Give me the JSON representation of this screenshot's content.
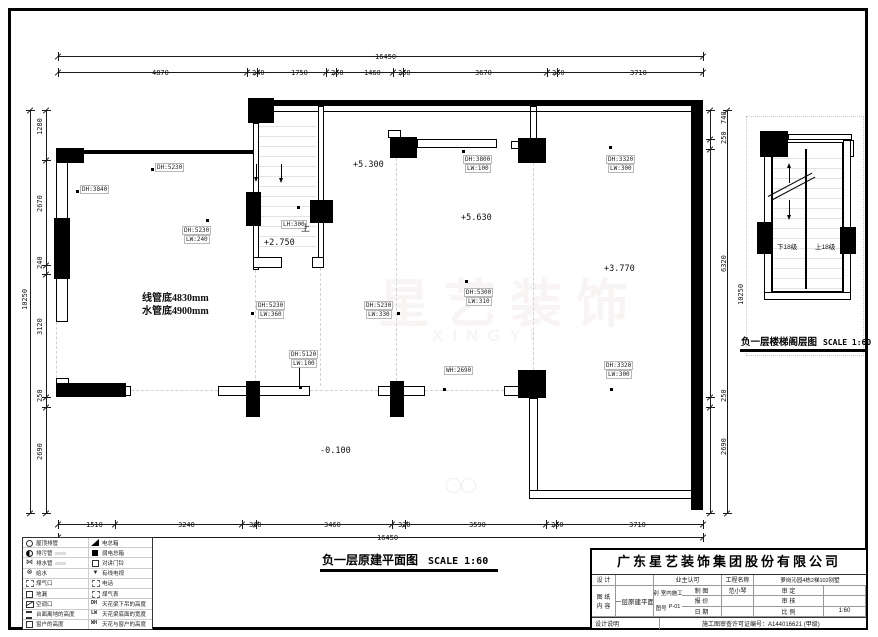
{
  "titles": {
    "main": "负一层原建平面图",
    "main_scale": "SCALE 1:60",
    "detail": "负一层楼梯阁层图",
    "detail_scale": "SCALE 1:60"
  },
  "watermark": {
    "cn": "星艺装饰",
    "en": "XINGYI"
  },
  "colors": {
    "wall": "#000000",
    "guide": "#d2d2d2",
    "watermark": "rgba(185,145,145,0.10)"
  },
  "plan": {
    "solid": [
      [
        248,
        98,
        26,
        25
      ],
      [
        253,
        100,
        450,
        6
      ],
      [
        56,
        148,
        28,
        15
      ],
      [
        56,
        150,
        197,
        4
      ],
      [
        54,
        218,
        16,
        61
      ],
      [
        56,
        383,
        70,
        14
      ],
      [
        246,
        192,
        15,
        34
      ],
      [
        310,
        200,
        23,
        23
      ],
      [
        390,
        137,
        27,
        21
      ],
      [
        518,
        138,
        28,
        25
      ],
      [
        691,
        100,
        12,
        410
      ],
      [
        246,
        381,
        14,
        36
      ],
      [
        390,
        381,
        14,
        36
      ],
      [
        518,
        370,
        28,
        28
      ],
      [
        760,
        131,
        28,
        26
      ],
      [
        757,
        222,
        15,
        32
      ],
      [
        840,
        227,
        16,
        27
      ]
    ],
    "hollow": [
      [
        56,
        150,
        12,
        172
      ],
      [
        253,
        123,
        6,
        147
      ],
      [
        253,
        257,
        29,
        11
      ],
      [
        318,
        106,
        6,
        152
      ],
      [
        312,
        257,
        12,
        11
      ],
      [
        388,
        130,
        13,
        8
      ],
      [
        417,
        139,
        80,
        9
      ],
      [
        530,
        106,
        7,
        33
      ],
      [
        511,
        141,
        8,
        8
      ],
      [
        218,
        386,
        92,
        10
      ],
      [
        378,
        386,
        47,
        10
      ],
      [
        56,
        378,
        13,
        6
      ],
      [
        122,
        386,
        9,
        10
      ],
      [
        504,
        386,
        15,
        10
      ],
      [
        529,
        398,
        9,
        96
      ],
      [
        529,
        490,
        168,
        9
      ],
      [
        788,
        134,
        64,
        6
      ],
      [
        848,
        140,
        6,
        17
      ],
      [
        764,
        140,
        8,
        158
      ],
      [
        843,
        140,
        8,
        158
      ],
      [
        764,
        292,
        87,
        8
      ]
    ],
    "outline": [
      [
        772,
        142,
        71,
        150
      ]
    ],
    "lines": [
      [
        259,
        111,
        59,
        1
      ],
      [
        323,
        111,
        368,
        1
      ],
      [
        299,
        366,
        1,
        20
      ],
      [
        805,
        149,
        2,
        140
      ]
    ],
    "guides": [
      [
        255,
        270,
        1,
        113
      ],
      [
        320,
        258,
        1,
        128
      ],
      [
        396,
        158,
        1,
        223
      ],
      [
        533,
        163,
        1,
        207
      ],
      [
        56,
        322,
        1,
        61
      ],
      [
        131,
        390,
        87,
        1
      ],
      [
        310,
        390,
        68,
        1
      ],
      [
        425,
        390,
        79,
        1
      ]
    ],
    "dotted_boxes": [
      [
        746,
        116,
        118,
        240
      ]
    ],
    "treads": [
      [
        259,
        117,
        57,
        138
      ],
      [
        773,
        149,
        69,
        140
      ]
    ],
    "rot_lines": [
      {
        "x": 768,
        "y": 196,
        "w": 50,
        "deg": -28
      },
      {
        "x": 771,
        "y": 200,
        "w": 50,
        "deg": -28
      }
    ],
    "arrows": [
      {
        "x": 256,
        "y": 164,
        "len": 13,
        "head": "down"
      },
      {
        "x": 281,
        "y": 164,
        "len": 14,
        "head": "down"
      },
      {
        "x": 789,
        "y": 168,
        "len": 15,
        "head": "up"
      },
      {
        "x": 789,
        "y": 200,
        "len": 15,
        "head": "down"
      }
    ],
    "dots": [
      [
        151,
        168
      ],
      [
        76,
        190
      ],
      [
        206,
        219
      ],
      [
        297,
        206
      ],
      [
        462,
        150
      ],
      [
        609,
        146
      ],
      [
        465,
        280
      ],
      [
        251,
        312
      ],
      [
        397,
        312
      ],
      [
        299,
        386
      ],
      [
        443,
        388
      ],
      [
        610,
        388
      ]
    ],
    "labels": [
      {
        "t": "DH:5230",
        "x": 155,
        "y": 163,
        "cls": "tag"
      },
      {
        "t": "DH:3840",
        "x": 80,
        "y": 185,
        "cls": "tag"
      },
      {
        "t": "DH:5230",
        "x": 182,
        "y": 226,
        "cls": "tag"
      },
      {
        "t": "LW:240",
        "x": 184,
        "y": 235,
        "cls": "tag"
      },
      {
        "t": "线管底4830mm",
        "x": 142,
        "y": 289,
        "cls": "big"
      },
      {
        "t": "水管底4900mm",
        "x": 142,
        "y": 302,
        "cls": "big"
      },
      {
        "t": "+2.750",
        "x": 264,
        "y": 238,
        "cls": "lvl"
      },
      {
        "t": "LH:300",
        "x": 281,
        "y": 220,
        "cls": "tag"
      },
      {
        "t": "上",
        "x": 301,
        "y": 221,
        "cls": "cn"
      },
      {
        "t": "+5.300",
        "x": 353,
        "y": 160,
        "cls": "lvl"
      },
      {
        "t": "DH:3800",
        "x": 463,
        "y": 155,
        "cls": "tag"
      },
      {
        "t": "LW:100",
        "x": 465,
        "y": 164,
        "cls": "tag"
      },
      {
        "t": "+5.630",
        "x": 461,
        "y": 213,
        "cls": "lvl"
      },
      {
        "t": "DH:3320",
        "x": 606,
        "y": 155,
        "cls": "tag"
      },
      {
        "t": "LW:300",
        "x": 608,
        "y": 164,
        "cls": "tag"
      },
      {
        "t": "+3.770",
        "x": 604,
        "y": 264,
        "cls": "lvl"
      },
      {
        "t": "DH:5300",
        "x": 464,
        "y": 288,
        "cls": "tag"
      },
      {
        "t": "LW:310",
        "x": 466,
        "y": 297,
        "cls": "tag"
      },
      {
        "t": "DH:5230",
        "x": 256,
        "y": 301,
        "cls": "tag"
      },
      {
        "t": "LW:360",
        "x": 258,
        "y": 310,
        "cls": "tag"
      },
      {
        "t": "DH:5230",
        "x": 364,
        "y": 301,
        "cls": "tag"
      },
      {
        "t": "LW:330",
        "x": 366,
        "y": 310,
        "cls": "tag"
      },
      {
        "t": "DH:5120",
        "x": 289,
        "y": 350,
        "cls": "tag"
      },
      {
        "t": "LW:100",
        "x": 291,
        "y": 359,
        "cls": "tag"
      },
      {
        "t": "WH:2690",
        "x": 444,
        "y": 366,
        "cls": "tag"
      },
      {
        "t": "DH:3320",
        "x": 604,
        "y": 361,
        "cls": "tag"
      },
      {
        "t": "LW:300",
        "x": 606,
        "y": 370,
        "cls": "tag"
      },
      {
        "t": "-0.100",
        "x": 320,
        "y": 446,
        "cls": "lvl"
      },
      {
        "t": "下18级",
        "x": 777,
        "y": 241,
        "cls": "cn7"
      },
      {
        "t": "上18级",
        "x": 815,
        "y": 241,
        "cls": "cn7"
      }
    ]
  },
  "dims": [
    {
      "o": "h",
      "y": 56,
      "x1": 58,
      "x2": 703,
      "ticks": [
        58,
        703
      ],
      "labels": [
        {
          "t": "16450",
          "p": 375
        }
      ]
    },
    {
      "o": "h",
      "y": 72,
      "x1": 58,
      "x2": 703,
      "ticks": [
        58,
        247,
        257,
        326,
        336,
        393,
        403,
        547,
        557,
        703
      ],
      "labels": [
        {
          "t": "4870",
          "p": 152
        },
        {
          "t": "240",
          "p": 252
        },
        {
          "t": "1750",
          "p": 291
        },
        {
          "t": "250",
          "p": 331
        },
        {
          "t": "1460",
          "p": 364
        },
        {
          "t": "250",
          "p": 398
        },
        {
          "t": "3670",
          "p": 475
        },
        {
          "t": "250",
          "p": 552
        },
        {
          "t": "3710",
          "p": 630
        }
      ]
    },
    {
      "o": "h",
      "y": 524,
      "x1": 58,
      "x2": 703,
      "ticks": [
        58,
        115,
        242,
        256,
        392,
        405,
        546,
        556,
        703
      ],
      "labels": [
        {
          "t": "1510",
          "p": 86
        },
        {
          "t": "3240",
          "p": 178
        },
        {
          "t": "360",
          "p": 249
        },
        {
          "t": "3460",
          "p": 324
        },
        {
          "t": "330",
          "p": 398
        },
        {
          "t": "3590",
          "p": 469
        },
        {
          "t": "250",
          "p": 551
        },
        {
          "t": "3710",
          "p": 629
        }
      ]
    },
    {
      "o": "h",
      "y": 537,
      "x1": 58,
      "x2": 703,
      "ticks": [
        58,
        703
      ],
      "labels": [
        {
          "t": "16450",
          "p": 377
        }
      ]
    },
    {
      "o": "v",
      "x": 30,
      "y1": 110,
      "y2": 513,
      "dx": -9,
      "ticks": [
        110,
        513
      ],
      "labels": [
        {
          "t": "10250",
          "p": 310
        }
      ]
    },
    {
      "o": "v",
      "x": 46,
      "y1": 110,
      "y2": 513,
      "dx": -10,
      "ticks": [
        110,
        160,
        265,
        274,
        397,
        407,
        513
      ],
      "labels": [
        {
          "t": "1280",
          "p": 135
        },
        {
          "t": "2670",
          "p": 212
        },
        {
          "t": "240",
          "p": 269
        },
        {
          "t": "3120",
          "p": 335
        },
        {
          "t": "250",
          "p": 402
        },
        {
          "t": "2690",
          "p": 460
        }
      ]
    },
    {
      "o": "v",
      "x": 710,
      "y1": 110,
      "y2": 513,
      "dx": 10,
      "ticks": [
        110,
        139,
        149,
        397,
        407,
        513
      ],
      "labels": [
        {
          "t": "740",
          "p": 124
        },
        {
          "t": "250",
          "p": 144
        },
        {
          "t": "6320",
          "p": 272
        },
        {
          "t": "250",
          "p": 402
        },
        {
          "t": "2690",
          "p": 455
        }
      ]
    },
    {
      "o": "v",
      "x": 727,
      "y1": 110,
      "y2": 513,
      "dx": 10,
      "ticks": [
        110,
        513
      ],
      "labels": [
        {
          "t": "10250",
          "p": 305
        }
      ]
    }
  ],
  "legend": {
    "rows": [
      {
        "li": "circ",
        "lt": "屋顶排管",
        "ri": "slope",
        "rt": "电总箱"
      },
      {
        "li": "half",
        "lt": "排污管",
        "ls": true,
        "ri": "sq",
        "rt": "弱电总箱"
      },
      {
        "li": "bow",
        "lt": "排水管",
        "ls": true,
        "ri": "osq",
        "rt": "对讲门铃"
      },
      {
        "li": "xcirc",
        "lt": "给水",
        "ri": "tri",
        "rt": "有线电视"
      },
      {
        "li": "dsq",
        "lt": "煤气口",
        "ri": "dsq",
        "rt": "电话"
      },
      {
        "li": "osq",
        "lt": "地漏",
        "ri": "dsq",
        "rt": "煤气表"
      },
      {
        "li": "ac",
        "lt": "空调口",
        "ri": "DH",
        "rt": "天花梁下吊的高度"
      },
      {
        "li": "bars",
        "lt": "台面离地的高度",
        "ri": "LW",
        "rt": "天花梁底面的宽度"
      },
      {
        "li": "osq",
        "lt": "窗户的高度",
        "ri": "WH",
        "rt": "天花与窗户的高度"
      }
    ]
  },
  "titleblock": {
    "company": "广东星艺装饰集团股份有限公司",
    "col1": [
      {
        "l": "设 计",
        "v": ""
      },
      {
        "l": "制 图",
        "v": "范小琴"
      },
      {
        "l": "报 价",
        "v": ""
      },
      {
        "l": "日 期",
        "v": ""
      }
    ],
    "col2": [
      {
        "l": "业主认可",
        "v": ""
      },
      {
        "l": "审 定",
        "v": ""
      },
      {
        "l": "审 核",
        "v": ""
      },
      {
        "l": "比 例",
        "v": "1:60"
      }
    ],
    "project_label": "工程名称",
    "project": "萝岗沁园4栋2梯102别墅",
    "sheet_label_1": "图 纸",
    "sheet_label_2": "内 容",
    "content": "负一层原建平面图",
    "cat_label": "图别",
    "cat": "室内施工图",
    "no_label": "图号",
    "no": "P-01",
    "note": "设计说明",
    "permit": "施工图审查许可证编号：A144016621 (甲级)"
  }
}
